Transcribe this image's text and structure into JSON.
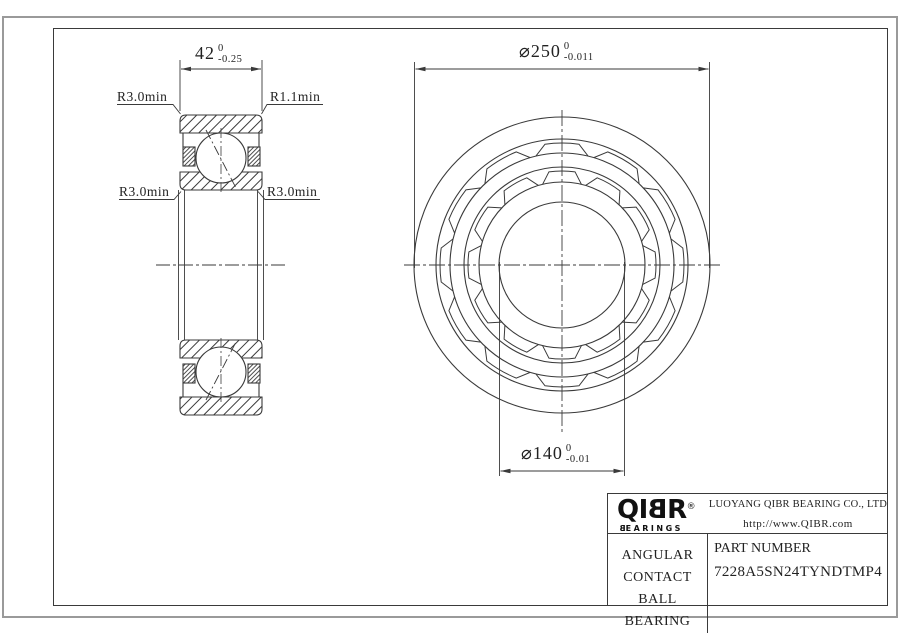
{
  "drawing": {
    "section_view": {
      "dim_width": {
        "value": "42",
        "tol_upper": "0",
        "tol_lower": "-0.25"
      },
      "label_outer_left": "R3.0min",
      "label_outer_right": "R1.1min",
      "label_inner_left": "R3.0min",
      "label_inner_right": "R3.0min"
    },
    "front_view": {
      "dim_outer_diameter": {
        "value": "⌀250",
        "tol_upper": "0",
        "tol_lower": "-0.011"
      },
      "dim_bore_diameter": {
        "value": "⌀140",
        "tol_upper": "0",
        "tol_lower": "-0.01"
      }
    }
  },
  "title_block": {
    "logo": {
      "l1": "Q",
      "l2": "I",
      "l3": "B",
      "l4": "R",
      "registered": "®",
      "sub_first": "B",
      "sub_rest": "EARINGS"
    },
    "company": "LUOYANG QIBR BEARING CO., LTD",
    "website": "http://www.QIBR.com",
    "product_type_line1": "ANGULAR CONTACT",
    "product_type_line2": "BALL BEARING",
    "part_number_label": "PART NUMBER",
    "part_number": "7228A5SN24TYNDTMP4"
  },
  "colors": {
    "line": "#3a3a3a",
    "sheet_border": "#9a9a9a",
    "background": "#ffffff"
  }
}
